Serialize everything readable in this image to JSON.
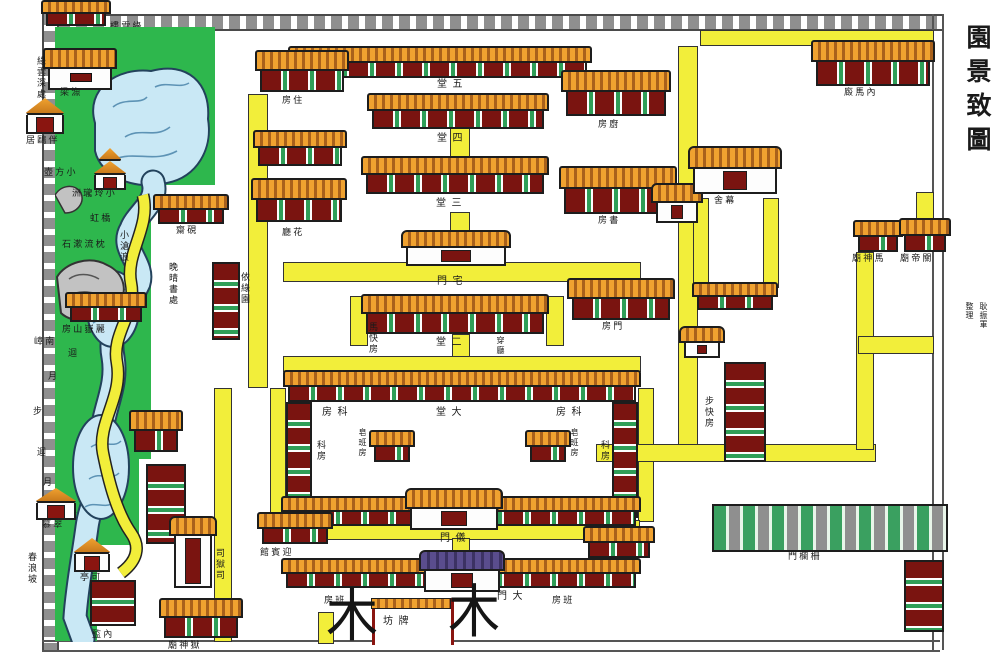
{
  "title": {
    "text": "東昌府署與古依綠園景致圖",
    "credit_name": "耿振軍",
    "credit_role": "整理"
  },
  "garden": {
    "tower_label": "樓雲綠",
    "deep_label": "綠雲深處",
    "yuliang": "梁漁",
    "banouju": "居鷗伴",
    "xiaofanghu": "壺方小",
    "linglongzhou": "洲瓏玲小",
    "bridge": "虹橋",
    "zhenliu": "石漱流枕",
    "shanfang": "房山嶽麗",
    "canglang": "小滄浪",
    "nanzhang": "嶂南",
    "path_chars": {
      "c1": "迴",
      "c2": "月",
      "c3": "步",
      "c4": "迴",
      "c5": "月",
      "c6": "步"
    },
    "mucui": "慕翠",
    "chunlangpo": "春浪坡",
    "keting": "亭可"
  },
  "yamen": {
    "wutang": "堂五",
    "sitang": "堂四",
    "santang": "堂三",
    "ertang": "堂二",
    "datang": "堂大",
    "zhaimen": "門宅",
    "yimen": "門儀",
    "damen": "門大",
    "paifang": "坊牌",
    "zhufang": "房住",
    "huating": "廳花",
    "yanzhai": "齋硯",
    "chufang": "房廚",
    "shufang": "房書",
    "menfang": "房門",
    "mushe": "舍幕",
    "neimajiu": "廄馬內",
    "mashenmiao": "廟神馬",
    "guandimiao": "廟帝關",
    "kefang_h": "房科",
    "kefang_v": "科房",
    "zaobanfang": "皂班房",
    "makuaifang": "馬快房",
    "bukuaifang": "步快房",
    "chuanting": "穿廳",
    "yingbinguan": "館賓迎",
    "tudici": "祠地土",
    "zhalanmen": "門欄柵",
    "banfang": "房班",
    "siyusi": "司獄司",
    "yushenmiao": "廟神獄",
    "neijian": "監內",
    "wanqing": "晚晴書處",
    "yilvyuan": "依綠園",
    "tree": "木"
  },
  "colors": {
    "garden_green": "#2eb74d",
    "water": "#c9e8f5",
    "path_yellow": "#f2ee3a",
    "roof_orange": "#f0a230",
    "panel_maroon": "#7a1410",
    "post_green": "#2f9e57"
  }
}
